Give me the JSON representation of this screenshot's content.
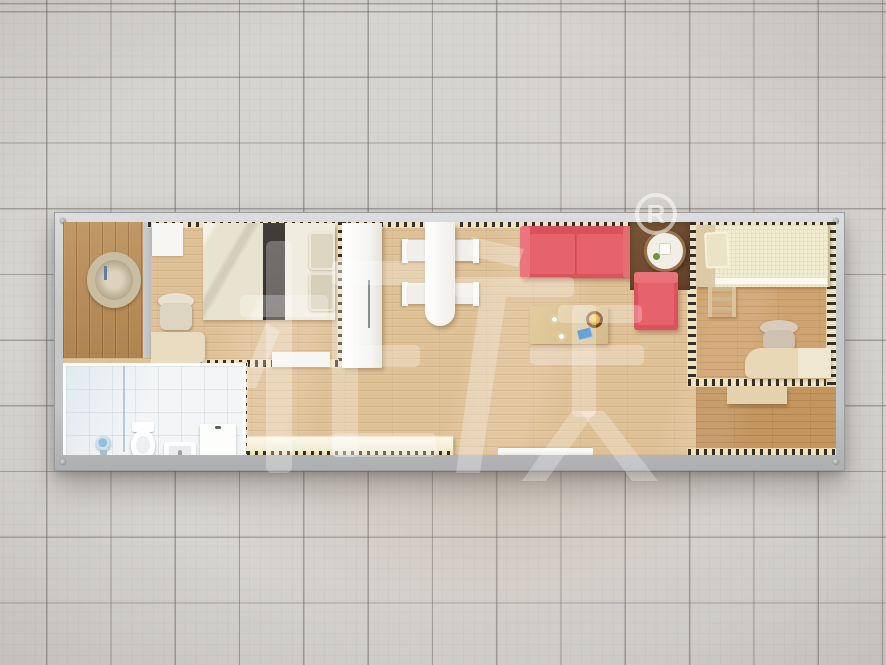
{
  "scene": {
    "title": "Container house floor plan — top-down 3D render",
    "background_label": "gray ceramic tile showroom floor",
    "frame_label": "gray container frame",
    "watermark": {
      "text": "柜族",
      "registered_letter": "R",
      "registered_symbol": "®",
      "color": "#ffffff"
    }
  },
  "palette": {
    "tile": "#d6d4d1",
    "grout": "#a29e99",
    "frame_gray": "#c7c8ca",
    "wood_light": "#dec197",
    "wood_entry": "#b98c55",
    "wood_bedroom2": "#d0a471",
    "wood_corridor": "#c3955f",
    "bath_white": "#f3f5f6",
    "sofa_red": "#e4626a",
    "bed2_cream": "#f1ecd0",
    "bench_cream": "#f5efda",
    "hatch_cream": "#f2e2c0",
    "hatch_dash": "#33302b",
    "mat_brown": "#6e4c30"
  },
  "rooms": {
    "entry": {
      "label": "Entry porch",
      "decor": "Round wreath wall decor"
    },
    "bedroom1": {
      "label": "Bedroom 1",
      "furniture": [
        "Wall cabinet",
        "Double bed with dark runner",
        "Pillows",
        "Desk",
        "Desk chair",
        "Sliding door"
      ]
    },
    "bathroom": {
      "label": "Bathroom",
      "furniture": [
        "Shower head",
        "Floor drain",
        "Glass divider",
        "Toilet",
        "Wash basin",
        "Storage cabinet"
      ]
    },
    "hall": {
      "label": "Hall / Dining area",
      "furniture": [
        "Wardrobe",
        "Dining table",
        "Dining chair",
        "Window bench",
        "Door threshold"
      ]
    },
    "living": {
      "label": "Living area",
      "furniture": [
        "Red sofa",
        "Coffee table",
        "Fruit bowl",
        "Cups",
        "Red armchair",
        "Round side table",
        "Corner mat"
      ]
    },
    "bedroom2": {
      "label": "Bedroom 2",
      "furniture": [
        "Single bed",
        "Step ladder",
        "Desk chair",
        "Corner desk",
        "Console table"
      ]
    }
  }
}
